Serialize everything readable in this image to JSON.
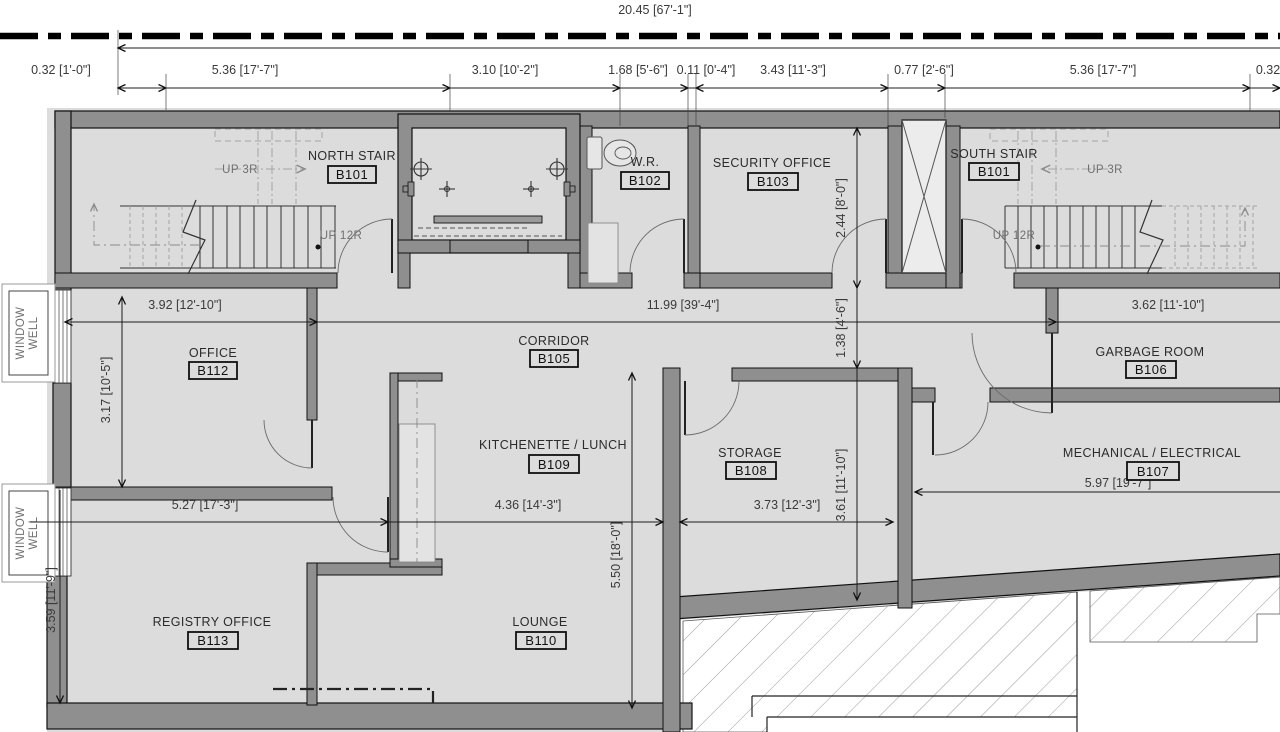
{
  "drawing_type": "basement floor plan",
  "colors": {
    "wall_fill": "#8f8f8f",
    "floor_fill": "#dcdcdc",
    "line": "#111111",
    "dim_text": "#3a3a3a",
    "annotation_text": "#6f6f6f",
    "hatch": "#999999"
  },
  "rooms": {
    "north_stair": {
      "name": "NORTH STAIR",
      "number": "B101"
    },
    "wr": {
      "name": "W.R.",
      "number": "B102"
    },
    "security": {
      "name": "SECURITY OFFICE",
      "number": "B103"
    },
    "south_stair": {
      "name": "SOUTH STAIR",
      "number": "B101"
    },
    "corridor": {
      "name": "CORRIDOR",
      "number": "B105"
    },
    "garbage": {
      "name": "GARBAGE ROOM",
      "number": "B106"
    },
    "mechanical": {
      "name": "MECHANICAL / ELECTRICAL",
      "number": "B107"
    },
    "storage": {
      "name": "STORAGE",
      "number": "B108"
    },
    "kitchenette": {
      "name": "KITCHENETTE / LUNCH",
      "number": "B109"
    },
    "lounge": {
      "name": "LOUNGE",
      "number": "B110"
    },
    "office": {
      "name": "OFFICE",
      "number": "B112"
    },
    "registry": {
      "name": "REGISTRY OFFICE",
      "number": "B113"
    }
  },
  "dims": {
    "overall": "20.45 [67'-1\"]",
    "top": [
      "0.32 [1'-0\"]",
      "5.36 [17'-7\"]",
      "3.10 [10'-2\"]",
      "1.68 [5'-6\"]",
      "0.11 [0'-4\"]",
      "3.43 [11'-3\"]",
      "0.77 [2'-6\"]",
      "5.36 [17'-7\"]",
      "0.32"
    ],
    "mid": [
      "3.92 [12'-10\"]",
      "11.99 [39'-4\"]",
      "3.62 [11'-10\"]"
    ],
    "lower": [
      "5.27 [17'-3\"]",
      "4.36 [14'-3\"]",
      "3.73 [12'-3\"]",
      "5.97 [19'-7\"]"
    ],
    "vertical": [
      "2.44 [8'-0\"]",
      "1.38 [4'-6\"]",
      "3.61 [11'-10\"]",
      "5.50 [18'-0\"]",
      "3.17 [10'-5\"]",
      "3.59 [11'-9\"]"
    ]
  },
  "annotations": {
    "up_3r": "UP 3R",
    "up_12r": "UP 12R",
    "window_well_line1": "WINDOW",
    "window_well_line2": "WELL"
  }
}
